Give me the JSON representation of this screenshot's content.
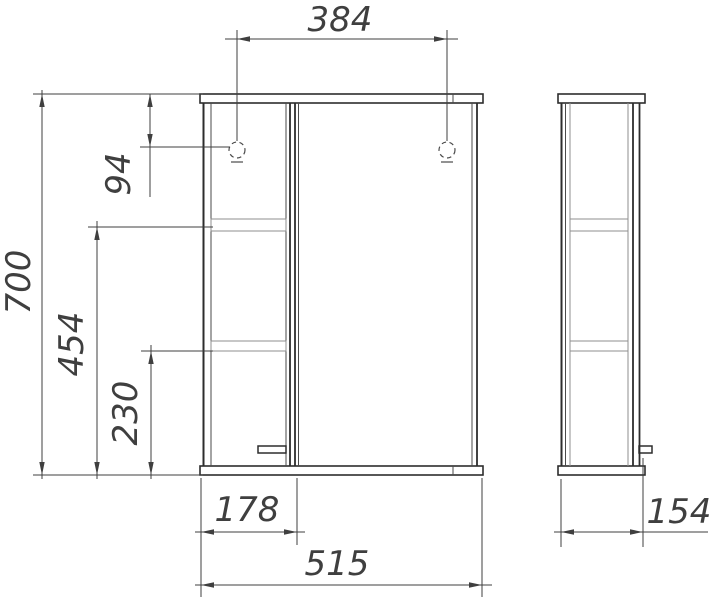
{
  "drawing": {
    "kind": "cabinet-orthographic-technical-drawing",
    "colors": {
      "background": "#ffffff",
      "outline": "#2d2d2d",
      "thin_line": "#4a4a4a",
      "light_line": "#8f8f8f",
      "dimension": "#3f3f3f"
    },
    "dimensions_mm": {
      "hanger_spacing": "384",
      "overall_height": "700",
      "hanger_drop": "94",
      "upper_shelf_height": "454",
      "lower_shelf_height": "230",
      "shelf_section_width": "178",
      "overall_width": "515",
      "depth": "154"
    }
  }
}
